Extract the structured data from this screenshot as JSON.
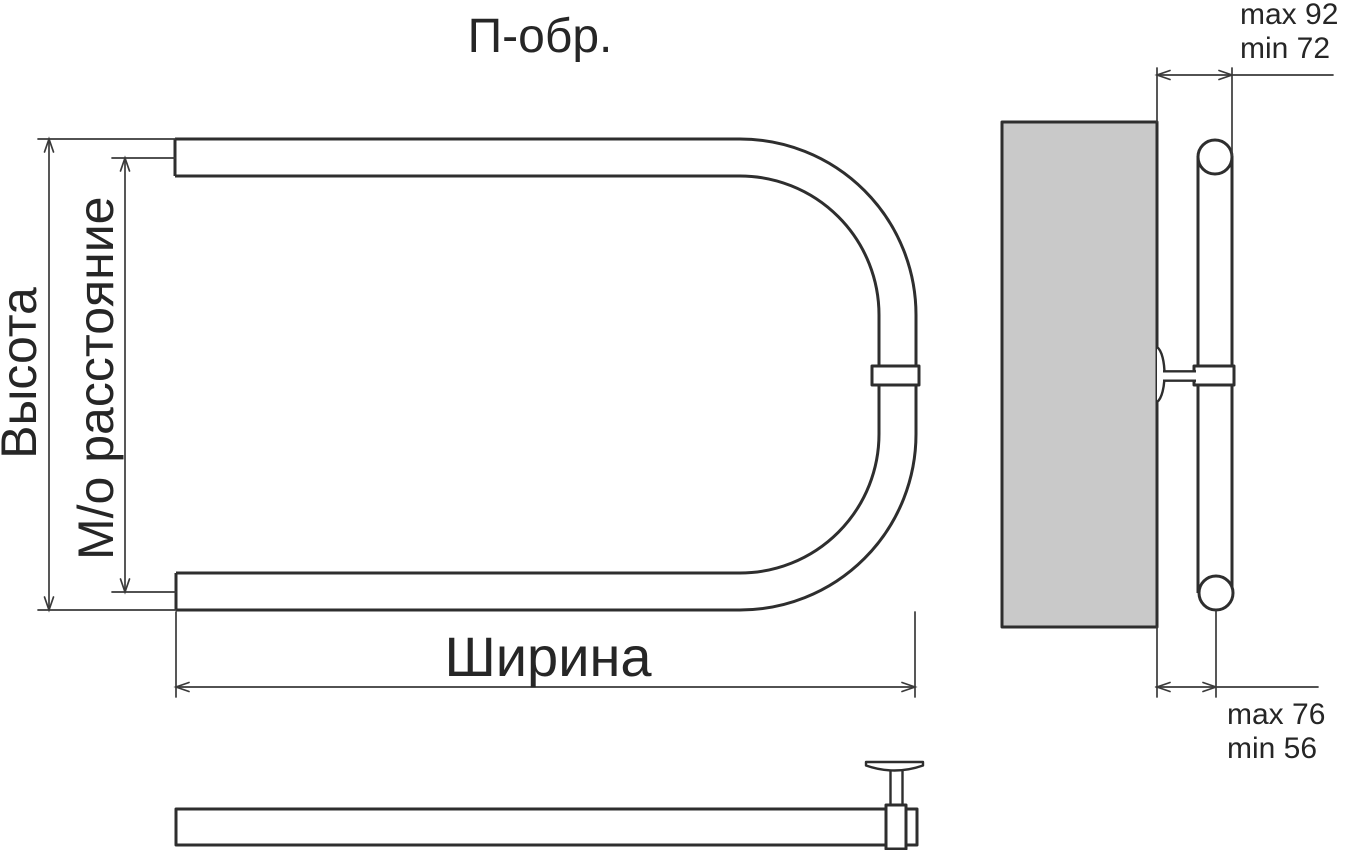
{
  "title": "П-обр.",
  "front_view": {
    "label_height": "Высота",
    "label_axial_distance": "М/о расстояние",
    "label_width": "Ширина"
  },
  "side_view": {
    "wall_offset_top": {
      "line1": "max 92",
      "line2": "min 72"
    },
    "wall_offset_bottom": {
      "line1": "max 76",
      "line2": "min 56"
    }
  },
  "colors": {
    "line": "#2e2e2e",
    "dim-line": "#3a3a3a",
    "wall-fill": "#c9c9c9",
    "text": "#262626",
    "background": "#ffffff"
  }
}
